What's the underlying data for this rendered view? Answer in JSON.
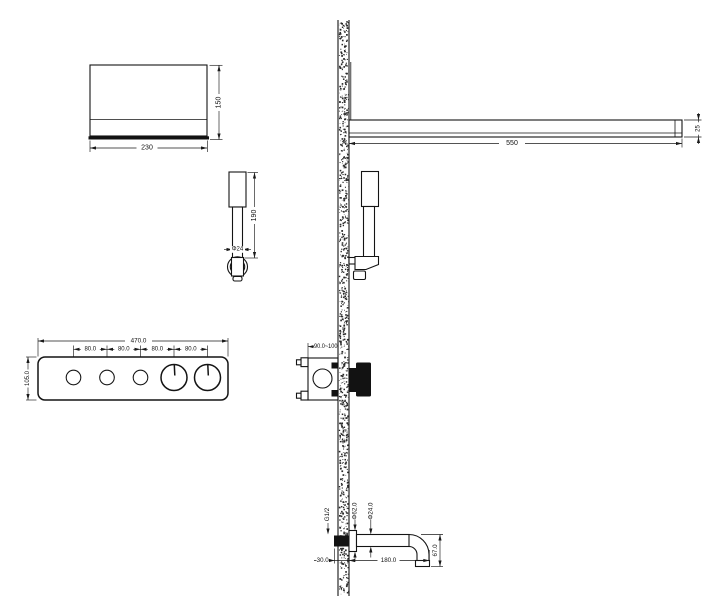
{
  "dimensions": {
    "overhead_shower": {
      "width": "230",
      "height": "150"
    },
    "hand_shower": {
      "length": "190",
      "diameter": "Φ24"
    },
    "control_panel": {
      "width": "470.0",
      "spacing": "80.0",
      "height": "105.0"
    },
    "shower_arm": {
      "length": "550",
      "thickness": "25"
    },
    "valve": {
      "embed_depth": "90.0~100"
    },
    "spout": {
      "thread": "G1/2",
      "flange_diameter": "Φ62.0",
      "pipe_diameter": "Φ24.0",
      "wall_depth": "30.0",
      "reach": "180.0",
      "drop_height": "67.0"
    }
  },
  "colors": {
    "line": "#141414",
    "background": "#ffffff"
  }
}
